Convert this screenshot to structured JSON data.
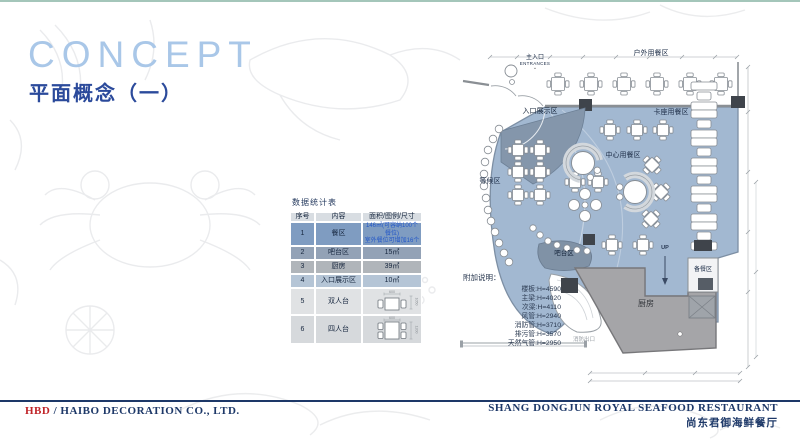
{
  "page": {
    "title": "CONCEPT",
    "subtitle": "平面概念（一）"
  },
  "stats_table": {
    "title": "数据统计表",
    "headers": [
      "序号",
      "内容",
      "面积/图例/尺寸"
    ],
    "rows": [
      {
        "no": "1",
        "name": "餐区",
        "value_lines": [
          "146㎡(可容纳100个餐位)",
          "室外餐位可增加16个"
        ]
      },
      {
        "no": "2",
        "name": "吧台区",
        "value_lines": [
          "15㎡"
        ]
      },
      {
        "no": "3",
        "name": "厨房",
        "value_lines": [
          "39㎡"
        ]
      },
      {
        "no": "4",
        "name": "入口展示区",
        "value_lines": [
          "10㎡"
        ]
      },
      {
        "no": "5",
        "name": "双人台",
        "diagram": {
          "type": "two-seat-table",
          "top_dim": "600",
          "side_dim": "1050"
        }
      },
      {
        "no": "6",
        "name": "四人台",
        "diagram": {
          "type": "four-seat-table",
          "top_dim": "600",
          "side_dim": "1200"
        }
      }
    ]
  },
  "floor_plan": {
    "labels": {
      "main_entrance_cn": "主入口",
      "main_entrance_en": "ENTRANCES",
      "outdoor_dining": "户外用餐区",
      "entry_display": "入口展示区",
      "booth_dining": "卡座用餐区",
      "center_dining": "中心用餐区",
      "waiting": "等候区",
      "bar": "吧台区",
      "kitchen": "厨房",
      "prep": "备餐区",
      "up": "UP",
      "fire_exit": "消防出口"
    },
    "notes": {
      "title": "附加说明：",
      "items": [
        "楼板:H=4590",
        "主梁:H=4020",
        "次梁:H=4110",
        "风管:H=2940",
        "消防管:H=3710",
        "排污管:H=3570",
        "天然气管:H=2950"
      ]
    }
  },
  "footer": {
    "company_prefix": "HBD",
    "company_suffix": " / HAIBO DECORATION CO., LTD.",
    "restaurant_en": "SHANG DONGJUN ROYAL SEAFOOD RESTAURANT",
    "restaurant_cn": "尚东君御海鲜餐厅"
  },
  "colors": {
    "top_accent": "#a4c6ba",
    "title_blue": "#a9c7e8",
    "subtitle_blue": "#2b4a9b",
    "plan_blue": "#a2b8d1",
    "display_slate": "#8496ab",
    "kitchen_gray": "#a5a5a8",
    "column_dark": "#3f444b",
    "footer_navy": "#1d3868",
    "hbd_red": "#c02428",
    "row1_bg": "#7f9cc1",
    "row2_bg": "#93a2b6",
    "row3_bg": "#b0b5ba",
    "row4_bg": "#b5c5d6",
    "row5_bg": "#e0e2e4",
    "row6_bg": "#d6d9dc",
    "row1_value_blue": "#2156c8"
  }
}
